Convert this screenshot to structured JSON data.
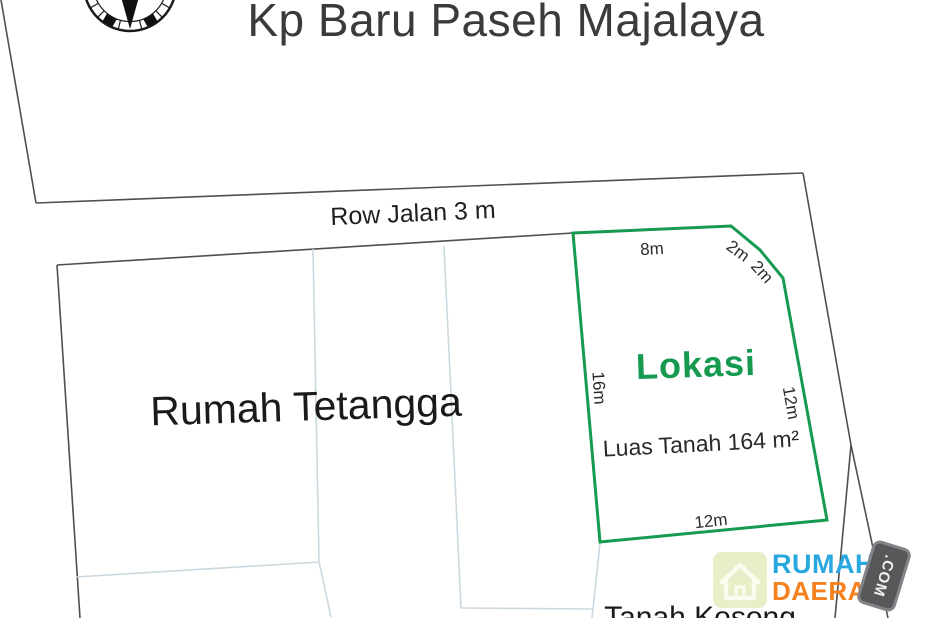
{
  "title": "Kp Baru Paseh Majalaya",
  "compass": {
    "icon": "compass-rose-icon"
  },
  "road": {
    "label": "Row Jalan 3 m"
  },
  "neighbor_area": {
    "label": "Rumah Tetangga"
  },
  "location_plot": {
    "label": "Lokasi",
    "area_label": "Luas Tanah 164 m²",
    "dimensions": {
      "top": "8m",
      "corner_upper": "2m",
      "corner_lower": "2m",
      "left": "16m",
      "right": "12m",
      "bottom": "12m"
    }
  },
  "empty_land": {
    "label": "Tanah Kosong"
  },
  "watermark_logo": {
    "word1": "RUMAH",
    "word2": "DAERAH",
    "suffix": ".COM",
    "house_icon": "house-icon"
  },
  "colors": {
    "plot_outline_green": "#169a50",
    "lokasi_text_green": "#169a50",
    "logo_blue": "#29a8e0",
    "logo_orange": "#f5821f",
    "tag_gray": "#57585a",
    "house_plate_beige": "#e9edc8",
    "divider_light_blue": "#ccd8df",
    "boundary_dark_gray": "#4f4f4f"
  }
}
